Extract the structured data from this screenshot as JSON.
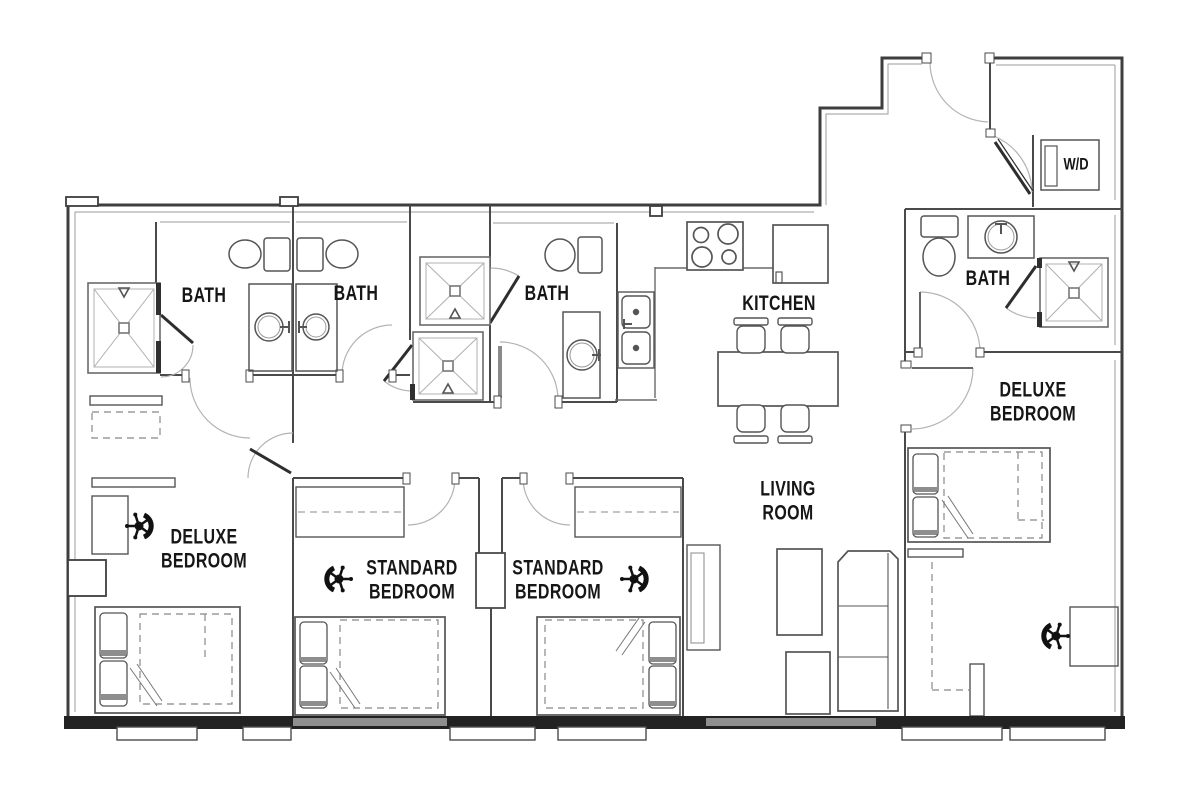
{
  "plan": {
    "background": "#ffffff",
    "wall_color": "#3e3e3e",
    "fixture_color": "#555555",
    "label_color": "#161616",
    "window_color": "#8f8f8f"
  },
  "rooms": {
    "bath_1": {
      "label": "BATH"
    },
    "bath_2": {
      "label": "BATH"
    },
    "bath_3": {
      "label": "BATH"
    },
    "bath_4": {
      "label": "BATH"
    },
    "kitchen": {
      "label": "KITCHEN"
    },
    "living_room": {
      "label": "LIVING ROOM"
    },
    "deluxe_bedroom_left": {
      "label": "DELUXE BEDROOM"
    },
    "deluxe_bedroom_right": {
      "label": "DELUXE BEDROOM"
    },
    "standard_bedroom_1": {
      "label": "STANDARD BEDROOM"
    },
    "standard_bedroom_2": {
      "label": "STANDARD BEDROOM"
    },
    "laundry_closet": {
      "label": "W/D"
    }
  }
}
